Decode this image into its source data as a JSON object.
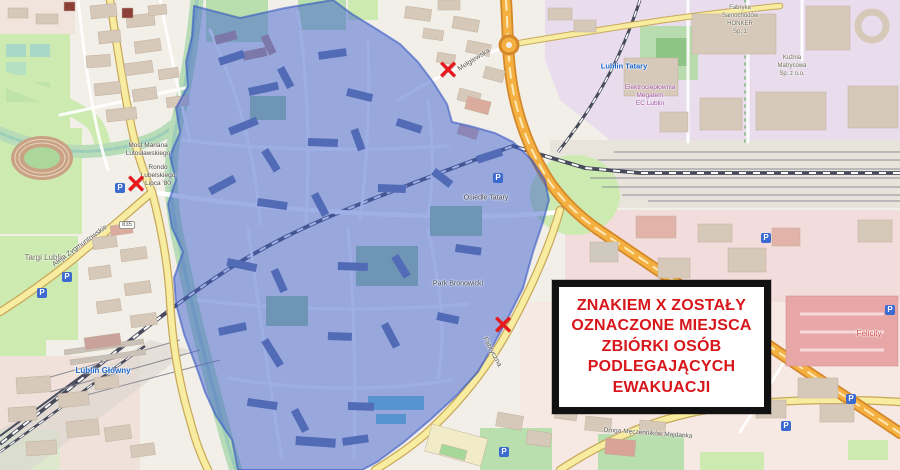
{
  "map": {
    "colors": {
      "zone_fill": "#3f62cf",
      "zone_stroke": "#2b4fc0",
      "marker_red": "#e8191c",
      "notice_text_red": "#d7171b",
      "notice_border": "#111111",
      "road_orange": "#f5b042",
      "road_yellow": "#f7eca0",
      "park_green": "#cdebb0"
    },
    "notice_box": {
      "lines": [
        "ZNAKIEM X ZOSTAŁY",
        "OZNACZONE MIEJSCA",
        "ZBIÓRKI OSÓB",
        "PODLEGAJĄCYCH",
        "EWAKUACJI"
      ]
    },
    "evacuation_markers": {
      "glyph": "✕",
      "items": [
        {
          "x": 448,
          "y": 71
        },
        {
          "x": 136,
          "y": 185
        },
        {
          "x": 503,
          "y": 326
        }
      ]
    },
    "parking_icons": {
      "glyph": "P",
      "items": [
        {
          "x": 120,
          "y": 188
        },
        {
          "x": 67,
          "y": 277
        },
        {
          "x": 42,
          "y": 293
        },
        {
          "x": 498,
          "y": 178
        },
        {
          "x": 766,
          "y": 238
        },
        {
          "x": 890,
          "y": 310
        },
        {
          "x": 851,
          "y": 399
        },
        {
          "x": 786,
          "y": 426
        },
        {
          "x": 504,
          "y": 452
        }
      ]
    },
    "region_names": [
      {
        "text": "Targi Lublin",
        "x": 45,
        "y": 258,
        "size": 8,
        "color": "#6b6b57"
      },
      {
        "text": "Lublin Główny",
        "x": 103,
        "y": 371,
        "size": 8,
        "color": "#1a66cc",
        "bold": true
      },
      {
        "text": "Lublin Tatary",
        "x": 624,
        "y": 66,
        "size": 7.5,
        "color": "#1a66cc",
        "bold": true
      },
      {
        "text": "Felicity",
        "x": 869,
        "y": 334,
        "size": 8,
        "color": "#cc4b4b"
      },
      {
        "text": "Most Mariana",
        "x": 148,
        "y": 146,
        "size": 6.5
      },
      {
        "text": "Lutosławskiego",
        "x": 148,
        "y": 154,
        "size": 6.5
      },
      {
        "text": "Rondo",
        "x": 158,
        "y": 168,
        "size": 6.5
      },
      {
        "text": "Lubelskiego",
        "x": 158,
        "y": 176,
        "size": 6.5
      },
      {
        "text": "Lipca '80",
        "x": 158,
        "y": 184,
        "size": 6.5
      },
      {
        "text": "Osiedle Tatary",
        "x": 486,
        "y": 198,
        "size": 7,
        "color": "#3c4455"
      },
      {
        "text": "Park Bronowicki",
        "x": 458,
        "y": 284,
        "size": 7,
        "color": "#3c4455"
      },
      {
        "text": "Elektrociepłownia",
        "x": 650,
        "y": 88,
        "size": 6.5,
        "color": "#a050a0"
      },
      {
        "text": "Megatem",
        "x": 650,
        "y": 96,
        "size": 6.5,
        "color": "#a050a0"
      },
      {
        "text": "EC Lublin",
        "x": 650,
        "y": 104,
        "size": 6.5,
        "color": "#a050a0"
      },
      {
        "text": "Fabryka",
        "x": 740,
        "y": 8,
        "size": 6,
        "color": "#6b6b57"
      },
      {
        "text": "Samochodów",
        "x": 740,
        "y": 16,
        "size": 6,
        "color": "#6b6b57"
      },
      {
        "text": "HONKER",
        "x": 740,
        "y": 24,
        "size": 6,
        "color": "#6b6b57"
      },
      {
        "text": "Sp. 1",
        "x": 740,
        "y": 32,
        "size": 6,
        "color": "#6b6b57"
      },
      {
        "text": "Kuźnia",
        "x": 792,
        "y": 58,
        "size": 6,
        "color": "#6b6b57"
      },
      {
        "text": "Matrycowa",
        "x": 792,
        "y": 66,
        "size": 6,
        "color": "#6b6b57"
      },
      {
        "text": "Sp. z o.o.",
        "x": 792,
        "y": 74,
        "size": 6,
        "color": "#6b6b57"
      },
      {
        "text": "Mełgiewska",
        "x": 474,
        "y": 60,
        "size": 7,
        "rot": -32,
        "color": "#55554d"
      },
      {
        "text": "Aleja Wincentego Witosa",
        "x": 716,
        "y": 312,
        "size": 7,
        "rot": 33,
        "color": "#55554d"
      },
      {
        "text": "Fabryczna",
        "x": 492,
        "y": 352,
        "size": 7,
        "rot": 62,
        "color": "#55554d"
      },
      {
        "text": "Droga Męczenników Majdanka",
        "x": 648,
        "y": 434,
        "size": 6.5,
        "rot": 4,
        "color": "#55554d"
      },
      {
        "text": "Aleja Zygmuntowskie",
        "x": 80,
        "y": 246,
        "size": 7,
        "rot": -36,
        "color": "#55554d"
      },
      {
        "text": "835",
        "x": 127,
        "y": 225,
        "size": 6,
        "shield": true
      }
    ]
  }
}
